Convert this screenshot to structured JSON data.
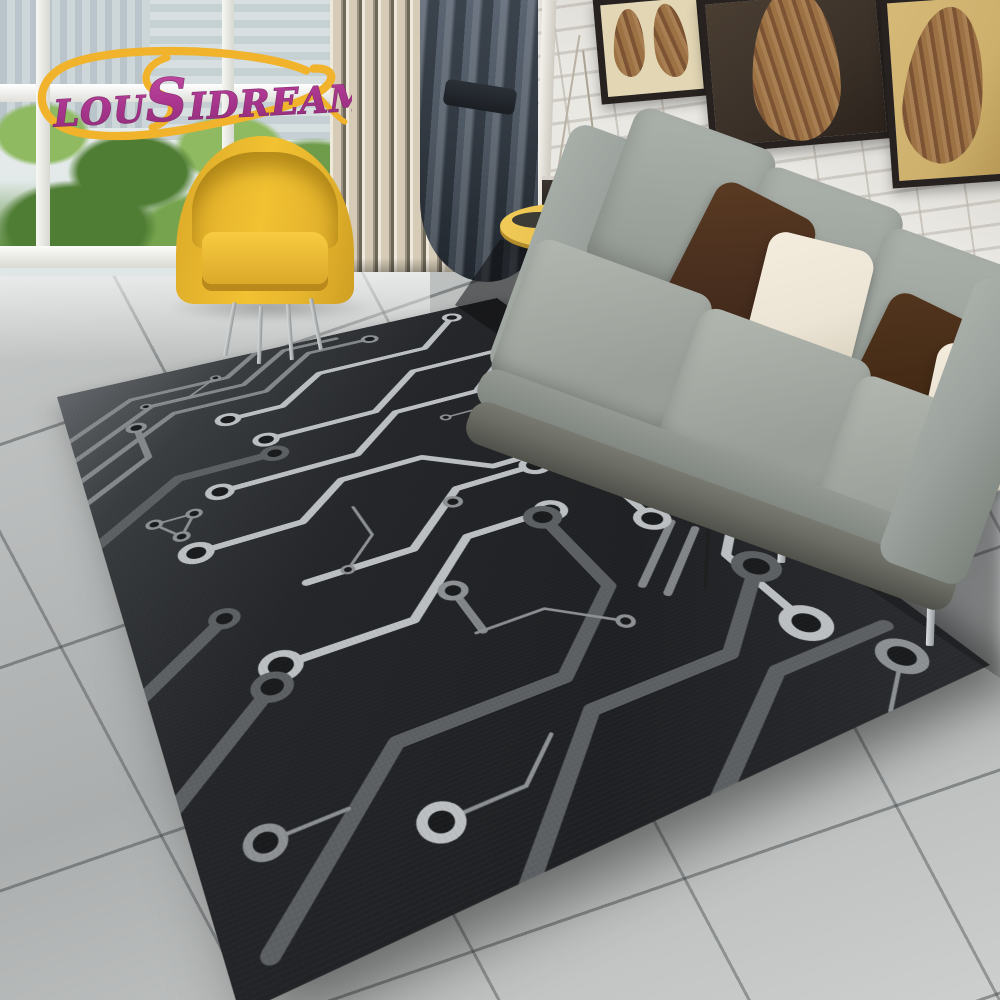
{
  "watermark": {
    "brand": "LOUSIDREAM",
    "brand_parts": {
      "p1": "LOU",
      "p2": "S",
      "p3": "IDREAM"
    }
  },
  "colors": {
    "logo-magenta": "#b03c92",
    "logo-magenta-dark": "#7e2a69",
    "logo-yellow": "#f1b32b",
    "rug-bg-far": "#63666a",
    "rug-bg": "#1e2023",
    "rug-hole": "#191b1d",
    "trace-bright": "#bcc0c2",
    "trace-mid": "#8d9194",
    "trace-dark": "#5d6063",
    "floor-mid": "#b5b8b8",
    "grout": "#73767a",
    "wall-brick": "#eae8e3",
    "wall-mortar": "#cfccc5",
    "sofa-gray": "#9ba19c",
    "sofa-base": "#6b6c64",
    "pillow-brown": "#4a2f1f",
    "pillow-brown-dark": "#3c2617",
    "pillow-cream": "#ece4d5",
    "chair-yellow": "#f2c232",
    "chair-yellow-dark": "#cf9f23",
    "table-wood": "#e9c14e",
    "curtain": "#46505c",
    "curtain-dark": "#2e3640",
    "slat": "#d6cbb6",
    "slat-gap": "#6f6758",
    "green-1": "#6f9c4a",
    "green-2": "#4f7d33",
    "green-3": "#8fba62",
    "building": "#b7c3c9",
    "art-frame": "#272220",
    "art-leaf-1": "#7c5434",
    "art-leaf-2": "#a87f52",
    "art-gold": "#cdb06c",
    "art-cream": "#e2d6b4",
    "art-darkbg": "#3a3028"
  },
  "scene": {
    "rug": "black circuit-board area rug with silver traces",
    "sofa": "gray fabric sofa with brown and cream pillows",
    "armchair": "yellow tub armchair",
    "side_table": "round wood side table",
    "curtain": "dark gray curtain",
    "wall": "white brick wall",
    "window": "window with city and tree view",
    "art": "three framed leaf prints"
  }
}
